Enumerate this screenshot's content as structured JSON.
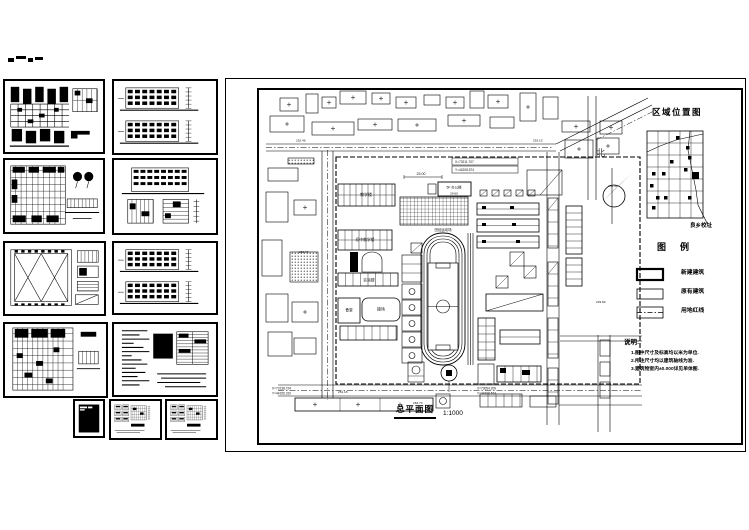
{
  "page": {
    "background": "#ffffff",
    "line_color": "#000000"
  },
  "thumbnails": [
    {
      "id": "floor-plan-1",
      "kind": "plan-dense",
      "x": 3,
      "y": 79,
      "w": 102,
      "h": 75
    },
    {
      "id": "elevations-1",
      "kind": "elev-pair",
      "x": 112,
      "y": 79,
      "w": 106,
      "h": 76
    },
    {
      "id": "floor-plan-2",
      "kind": "plan-grid-fig",
      "x": 3,
      "y": 158,
      "w": 102,
      "h": 76
    },
    {
      "id": "elevation-details",
      "kind": "elev-details",
      "x": 112,
      "y": 158,
      "w": 106,
      "h": 77
    },
    {
      "id": "roof-plan",
      "kind": "roof-x",
      "x": 3,
      "y": 241,
      "w": 103,
      "h": 75
    },
    {
      "id": "elevations-2",
      "kind": "elev-pair",
      "x": 112,
      "y": 241,
      "w": 106,
      "h": 74
    },
    {
      "id": "floor-plan-3",
      "kind": "plan-large",
      "x": 3,
      "y": 322,
      "w": 105,
      "h": 76
    },
    {
      "id": "schedule-sheet",
      "kind": "text-sheet",
      "x": 112,
      "y": 322,
      "w": 106,
      "h": 75
    },
    {
      "id": "cover-sheet",
      "kind": "dark-sheet",
      "x": 73,
      "y": 399,
      "w": 32,
      "h": 39
    },
    {
      "id": "detail-sheet-1",
      "kind": "details",
      "x": 109,
      "y": 399,
      "w": 53,
      "h": 41
    },
    {
      "id": "detail-sheet-2",
      "kind": "details",
      "x": 165,
      "y": 399,
      "w": 53,
      "h": 41
    }
  ],
  "sheet": {
    "caption": "总平面图",
    "scale": "1:1000",
    "north_label": "北",
    "location_map": {
      "title": "区域位置图",
      "pointer_label": "良乡校址"
    },
    "legend": {
      "title": "图例",
      "items": [
        {
          "symbol": "new-building",
          "label": "新建建筑"
        },
        {
          "symbol": "existing-building",
          "label": "原有建筑"
        },
        {
          "symbol": "site-boundary",
          "label": "用地红线"
        }
      ]
    },
    "notes": {
      "title": "说明:",
      "lines": [
        "1.图中尺寸及标高均以米为单位.",
        "2.所注尺寸均以建筑轴线为准.",
        "3.建筑物室内±0.000详见单体图."
      ]
    },
    "plan_labels": {
      "dim_top": "25.00",
      "office": "5F 办公楼",
      "office_height": "29.60",
      "teaching": "教学楼",
      "teaching_jr": "初中教学楼",
      "lab": "实验楼",
      "canteen": "食堂",
      "playground": "操场",
      "track": "田径运动场",
      "coord_top_x": "X=73211.707",
      "coord_top_y": "Y=44208.574",
      "coord_bl_x": "X=73138.724",
      "coord_bl_y": "Y=44156.310",
      "coord_br_x": "X=73054.209",
      "coord_br_y": "Y=44208.574",
      "spots": [
        "252.48",
        "253.15",
        "251.40",
        "250.73",
        "284.73",
        "249.80",
        "251.18"
      ]
    }
  }
}
